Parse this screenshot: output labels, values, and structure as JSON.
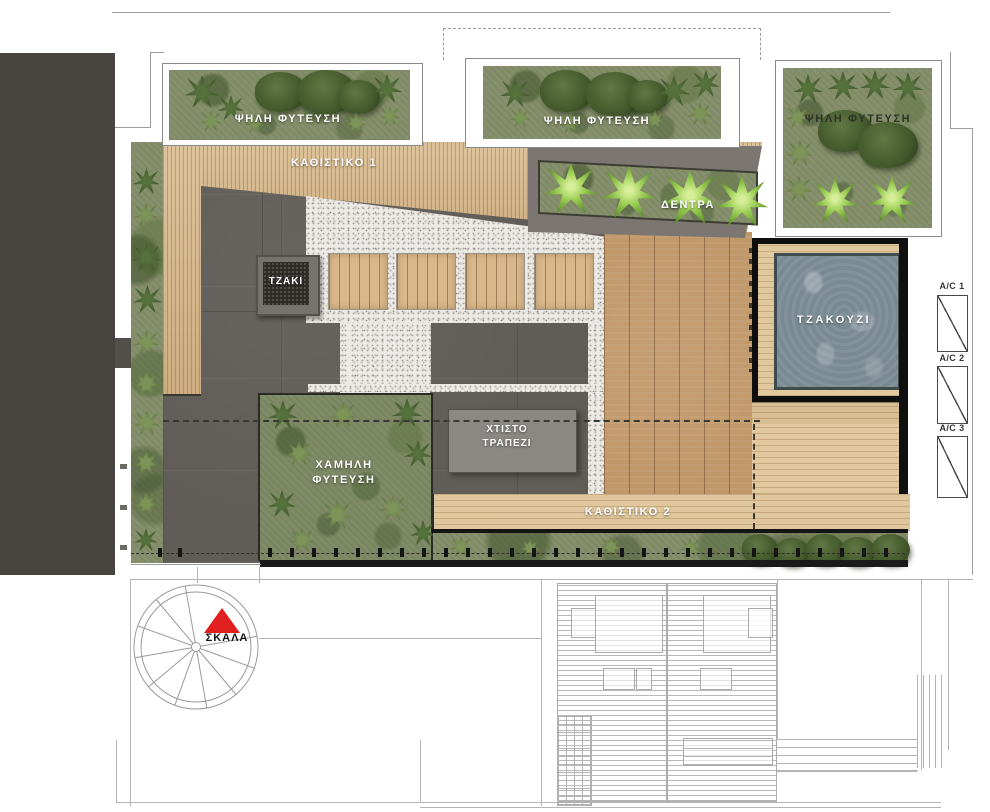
{
  "labels": {
    "high_planting_left": "ΨΗΛΗ ΦΥΤΕΥΣΗ",
    "high_planting_middle": "ΨΗΛΗ ΦΥΤΕΥΣΗ",
    "high_planting_right": "ΨΗΛΗ ΦΥΤΕΥΣΗ",
    "seating_1": "ΚΑΘΙΣΤΙΚΟ 1",
    "trees": "ΔΕΝΤΡΑ",
    "fireplace": "ΤΖΑΚΙ",
    "jacuzzi": "ΤΖΑΚΟΥΖΙ",
    "built_table_line1": "ΧΤΙΣΤΟ",
    "built_table_line2": "ΤΡΑΠΕΖΙ",
    "low_planting_line1": "ΧΑΜΗΛΗ",
    "low_planting_line2": "ΦΥΤΕΥΣΗ",
    "seating_2": "ΚΑΘΙΣΤΙΚΟ 2",
    "stairs": "ΣΚΑΛΑ"
  },
  "ac_units": [
    {
      "label": "A/C 1"
    },
    {
      "label": "A/C 2"
    },
    {
      "label": "A/C 3"
    }
  ],
  "colors": {
    "building_mass": "#48443f",
    "terrace_tile": "#605c57",
    "wood_light": "#d9bb8e",
    "wood_deck": "#c09768",
    "gravel": "#eceae6",
    "planting_green": "#87906c",
    "water": "#7a8a93",
    "stair_accent_red": "#e01f1f",
    "frame_black": "#0e0e0e"
  }
}
